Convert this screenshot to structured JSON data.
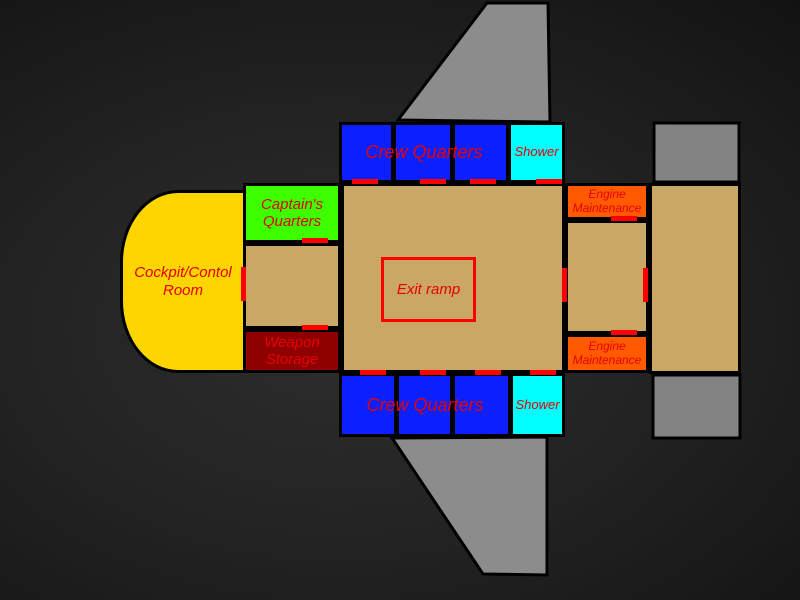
{
  "diagram": {
    "type": "spaceship-floor-plan"
  },
  "colors": {
    "hull_tan": "#cba766",
    "crew_blue": "#0b1fff",
    "shower_cyan": "#00ffff",
    "captains_green": "#3dff00",
    "cockpit_gold": "#ffd500",
    "weapon_dark_red": "#8f0000",
    "engine_orange": "#ff5a00",
    "wing_gray": "#8c8c8c",
    "engine_block_gray": "#838383",
    "door_red": "#ff0000",
    "label_red": "#e60000",
    "outline_black": "#000000"
  },
  "rooms": {
    "cockpit": {
      "line1": "Cockpit/Contol",
      "line2": "Room"
    },
    "captains_quarters": {
      "line1": "Captain's",
      "line2": "Quarters"
    },
    "weapon_storage": {
      "line1": "Weapon",
      "line2": "Storage"
    },
    "crew_quarters_top": {
      "label": "Crew Quarters"
    },
    "crew_quarters_bottom": {
      "label": "Crew Quarters"
    },
    "shower_top": {
      "label": "Shower"
    },
    "shower_bottom": {
      "label": "Shower"
    },
    "exit_ramp": {
      "label": "Exit ramp"
    },
    "engine_maintenance_top": {
      "line1": "Engine",
      "line2": "Maintenance"
    },
    "engine_maintenance_bottom": {
      "line1": "Engine",
      "line2": "Maintenance"
    }
  }
}
